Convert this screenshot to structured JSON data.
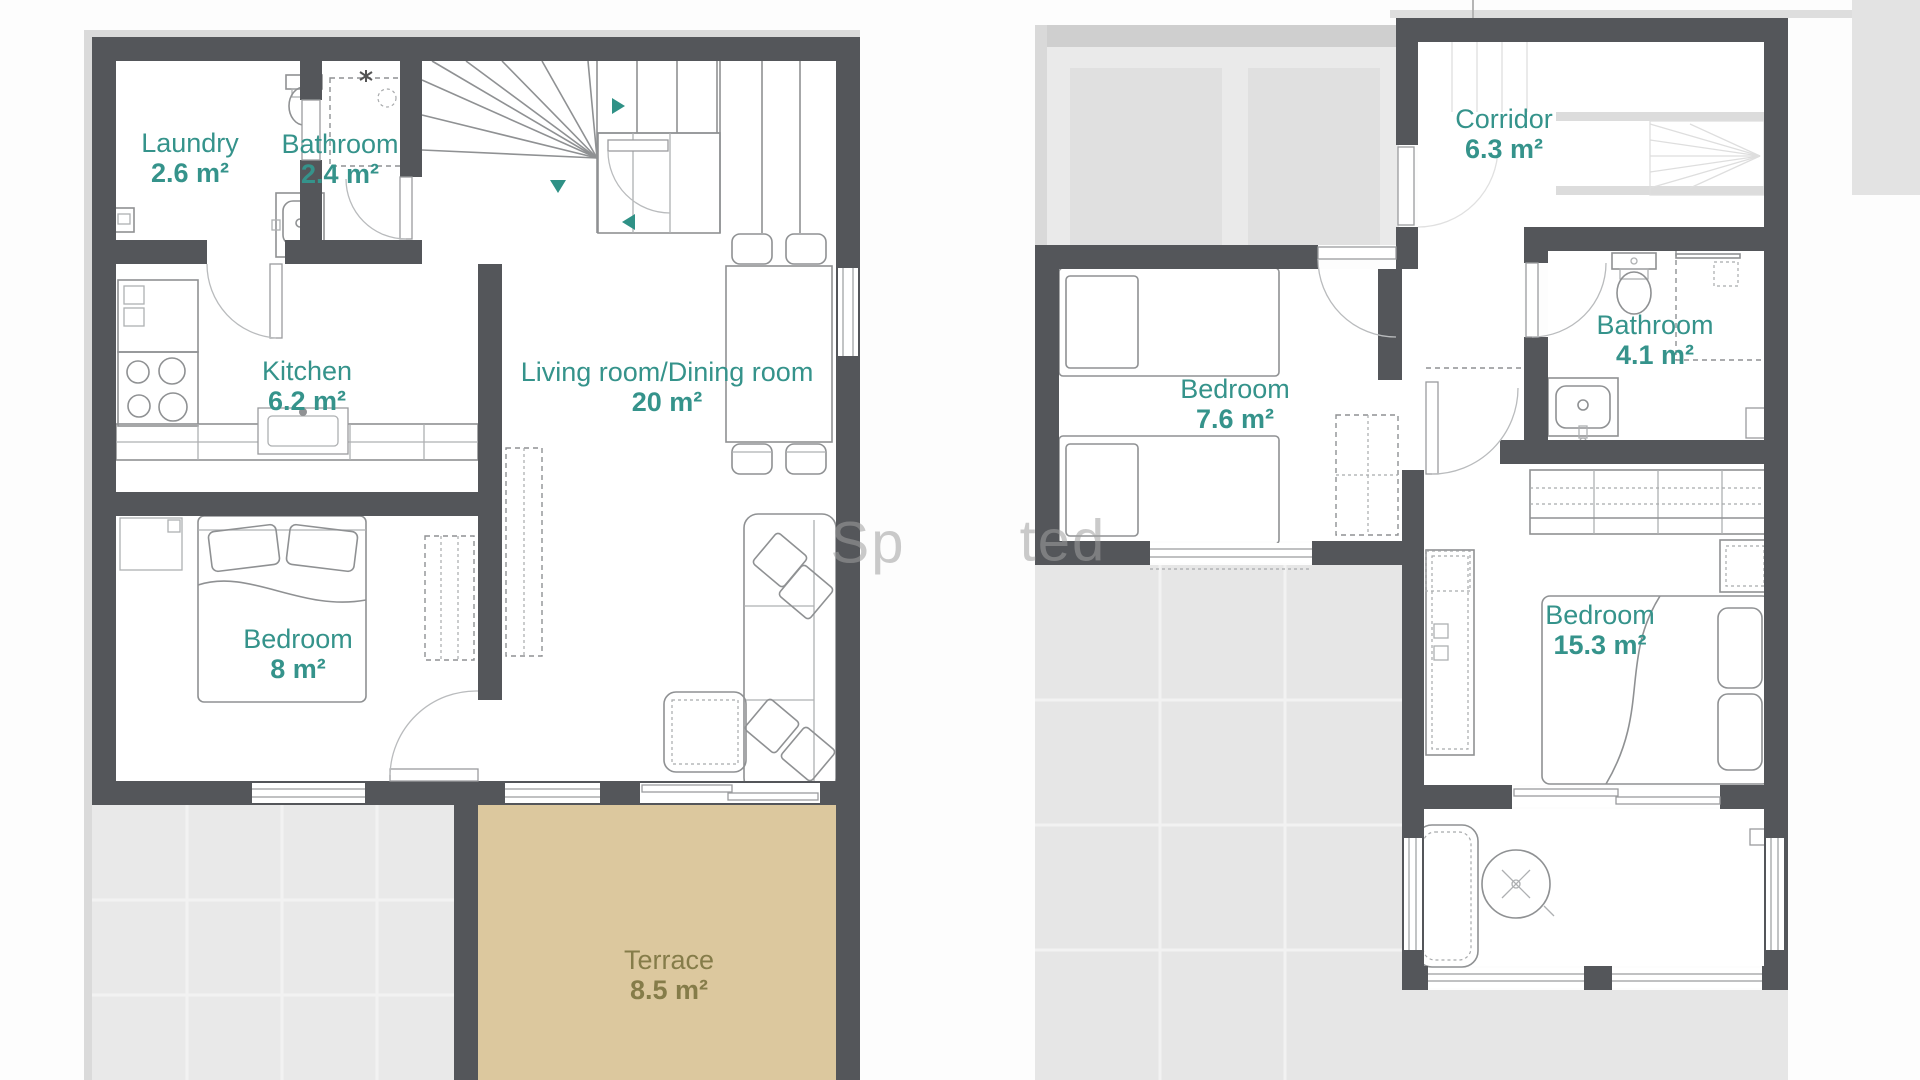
{
  "floors": [
    {
      "id": "left-plan",
      "rooms": [
        {
          "label": "Laundry",
          "area": "2.6 m²"
        },
        {
          "label": "Bathroom",
          "area": "2.4 m²"
        },
        {
          "label": "Kitchen",
          "area": "6.2 m²"
        },
        {
          "label": "Living room/Dining room",
          "area": "20 m²"
        },
        {
          "label": "Bedroom",
          "area": "8 m²"
        },
        {
          "label": "Terrace",
          "area": "8.5 m²"
        }
      ]
    },
    {
      "id": "right-plan",
      "rooms": [
        {
          "label": "Corridor",
          "area": "6.3 m²"
        },
        {
          "label": "Bedroom",
          "area": "7.6 m²"
        },
        {
          "label": "Bathroom",
          "area": "4.1 m²"
        },
        {
          "label": "Bedroom",
          "area": "15.3 m²"
        }
      ]
    }
  ],
  "watermark": {
    "fragment_left": "Sp",
    "fragment_right": "ted"
  },
  "colors": {
    "wall": "#54565a",
    "room_label": "#35938b",
    "terrace_fill": "#dcc89e",
    "terrace_label": "#857c49",
    "ghost_area": "#eaeaea",
    "ghost_wall": "#cfcfcf",
    "gray_zone": "#e7e7e7"
  }
}
